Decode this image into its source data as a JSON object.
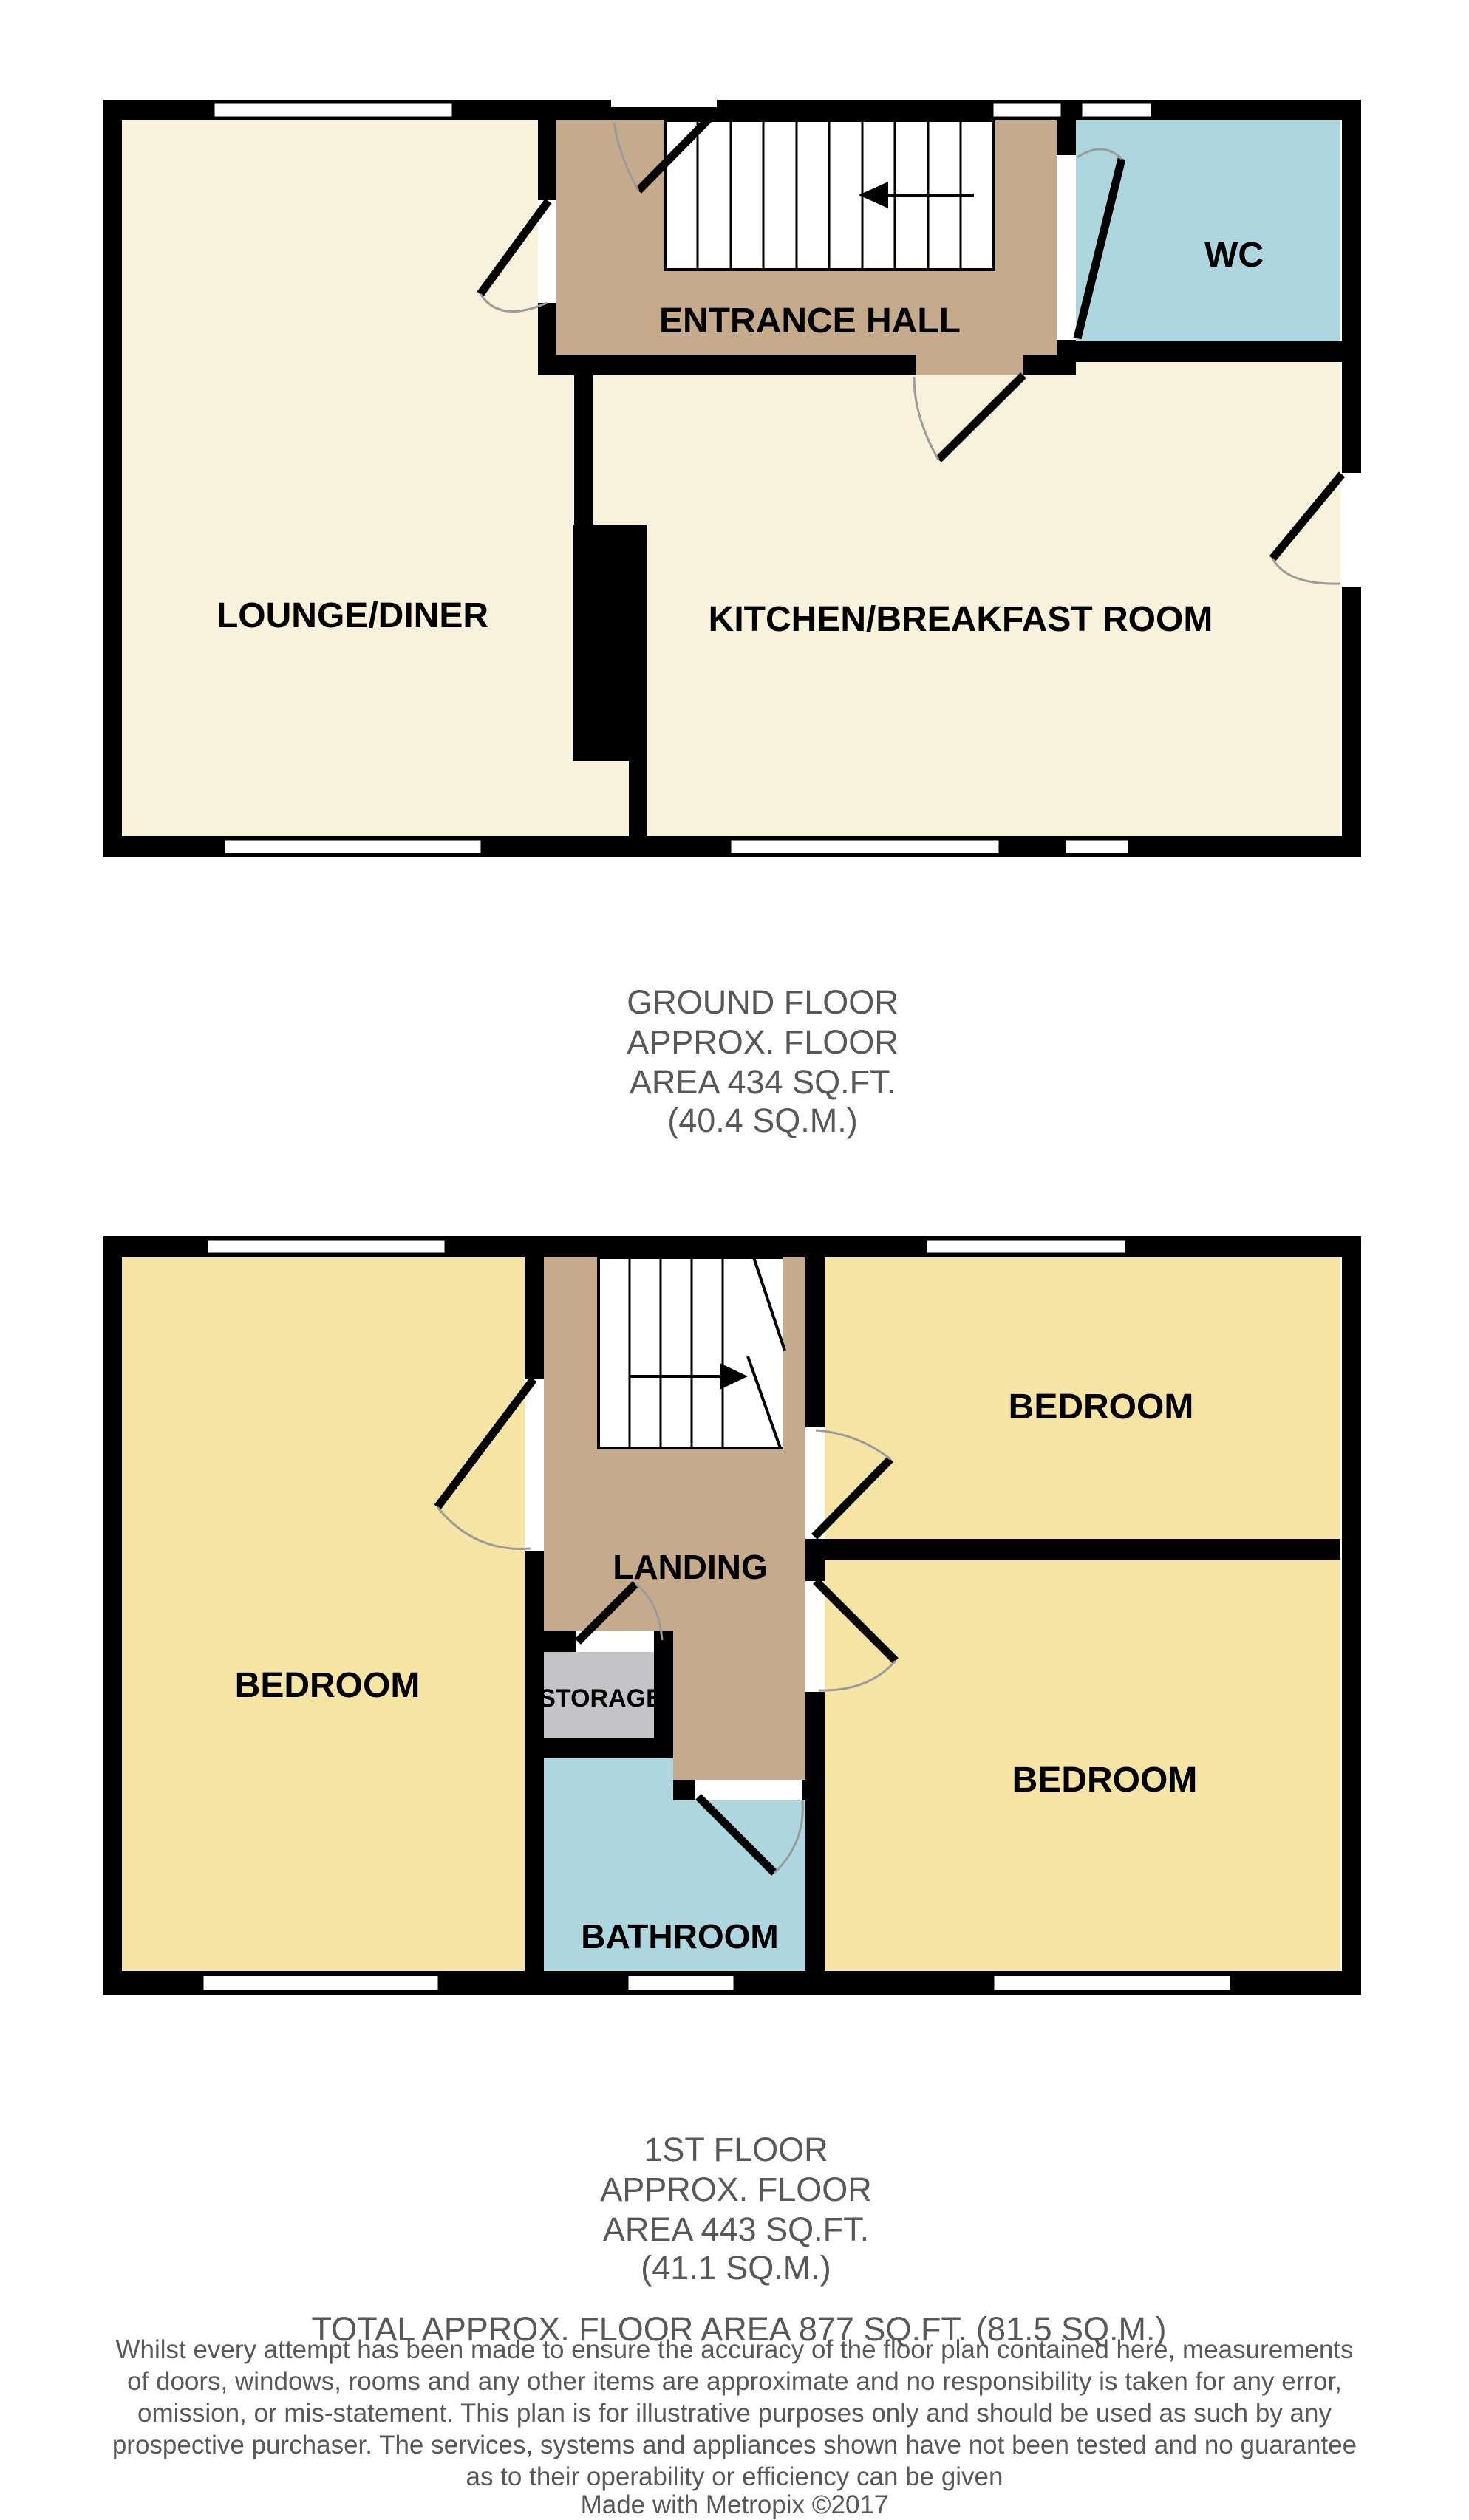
{
  "colors": {
    "cream": "#F8F2DA",
    "tan": "#C5AA8B",
    "blue": "#ADD6DF",
    "yellow": "#F6E4A4",
    "storage_gray": "#C4C3C7",
    "text_gray": "#58585A",
    "wall": "#000000",
    "arc_gray": "#9B9B9B"
  },
  "labels": {
    "lounge": "LOUNGE/DINER",
    "hall": "ENTRANCE HALL",
    "wc": "WC",
    "kitchen": "KITCHEN/BREAKFAST ROOM",
    "bedroom": "BEDROOM",
    "landing": "LANDING",
    "storage": "STORAGE",
    "bathroom": "BATHROOM"
  },
  "ground_summary": {
    "l1": "GROUND FLOOR",
    "l2": "APPROX. FLOOR",
    "l3": "AREA 434 SQ.FT.",
    "l4": "(40.4 SQ.M.)"
  },
  "first_summary": {
    "l1": "1ST FLOOR",
    "l2": "APPROX. FLOOR",
    "l3": "AREA 443 SQ.FT.",
    "l4": "(41.1 SQ.M.)"
  },
  "total": "TOTAL APPROX. FLOOR AREA 877 SQ.FT. (81.5 SQ.M.)",
  "disclaimer": {
    "l1": "Whilst every attempt has been made to ensure the accuracy of the floor plan contained here, measurements",
    "l2": "of doors, windows, rooms and any other items are approximate and no responsibility is taken for any error,",
    "l3": "omission, or mis-statement. This plan is for illustrative purposes only and should be used as such by any",
    "l4": "prospective purchaser. The services, systems and appliances shown have not been tested and no guarantee",
    "l5": "as to their operability or efficiency can be given",
    "l6": "Made with Metropix ©2017"
  }
}
